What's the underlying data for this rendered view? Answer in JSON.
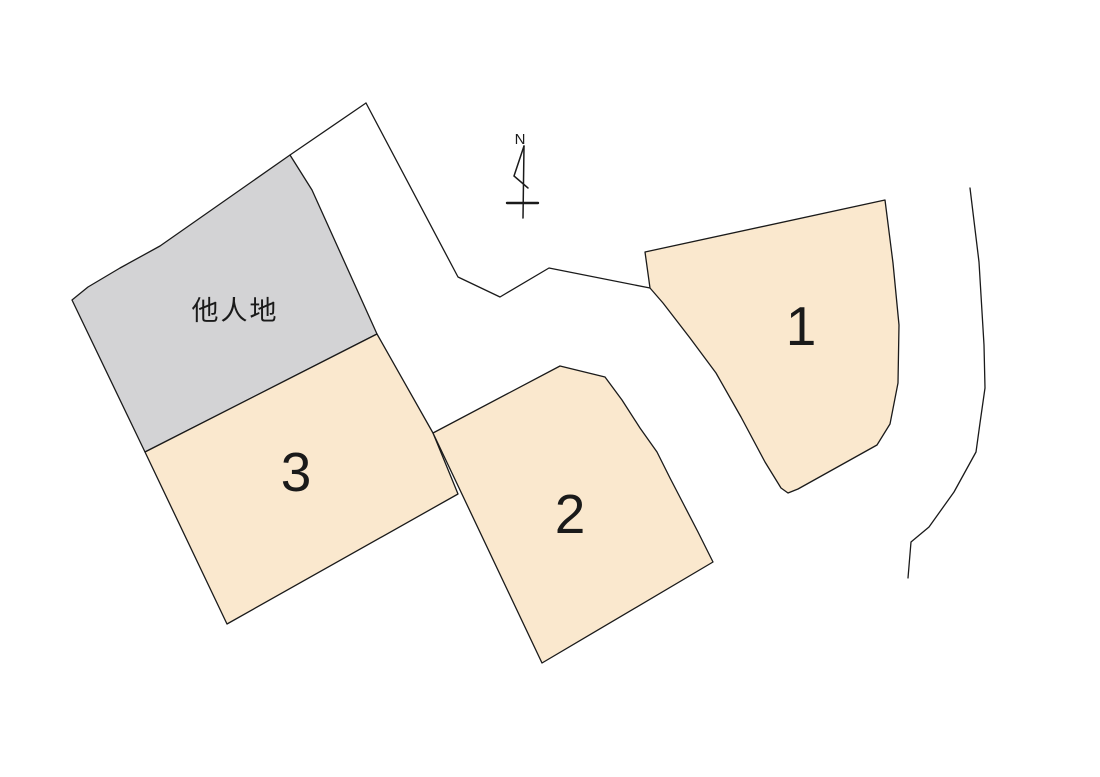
{
  "compass": {
    "label": "N"
  },
  "parcels": [
    {
      "number": "1"
    },
    {
      "number": "2"
    },
    {
      "number": "3"
    }
  ],
  "other_land": {
    "label": "他人地"
  },
  "colors": {
    "parcel_fill": "#FAE8CE",
    "other_land_fill": "#D3D3D5",
    "outline": "#1A1A1A",
    "label_color": "#1A1A1A",
    "background": "#FFFFFF"
  }
}
